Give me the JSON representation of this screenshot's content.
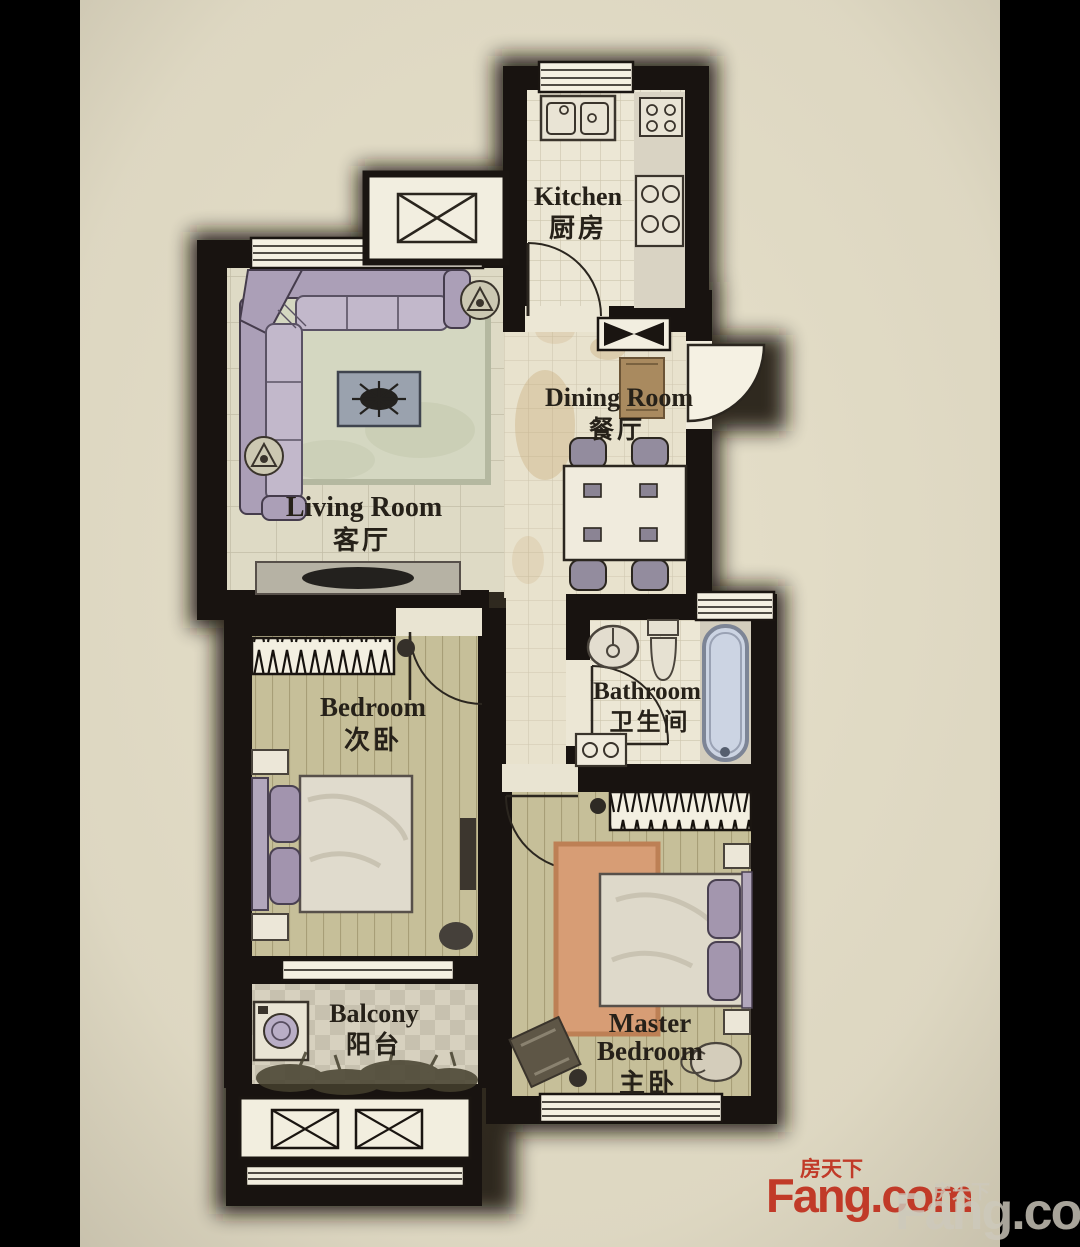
{
  "labels": {
    "kitchen": {
      "en": "Kitchen",
      "zh": "厨房"
    },
    "dining": {
      "en": "Dining Room",
      "zh": "餐厅"
    },
    "living": {
      "en": "Living Room",
      "zh": "客厅"
    },
    "bathroom": {
      "en": "Bathroom",
      "zh": "卫生间"
    },
    "bedroom": {
      "en": "Bedroom",
      "zh": "次卧"
    },
    "master": {
      "en1": "Master",
      "en2": "Bedroom",
      "zh": "主卧"
    },
    "balcony": {
      "en": "Balcony",
      "zh": "阳台"
    }
  },
  "watermarks": {
    "primary": {
      "brand": "Fang.com",
      "cn": "房天下",
      "color": "#c13a28"
    },
    "secondary": {
      "brand": "Fang.com",
      "cn": "房天下",
      "color": "#cdc9bc"
    }
  },
  "colors": {
    "paper": "#e7e1cb",
    "letterbox": "#000000",
    "wall": "#181310",
    "wood_floor": "#c6bf99",
    "tile": "#ece7d5",
    "rug_green": "#d4d7c1",
    "rug_salmon": "#d79d75",
    "tub": "#ccd4e3",
    "sofa": "#b1a5bd"
  }
}
